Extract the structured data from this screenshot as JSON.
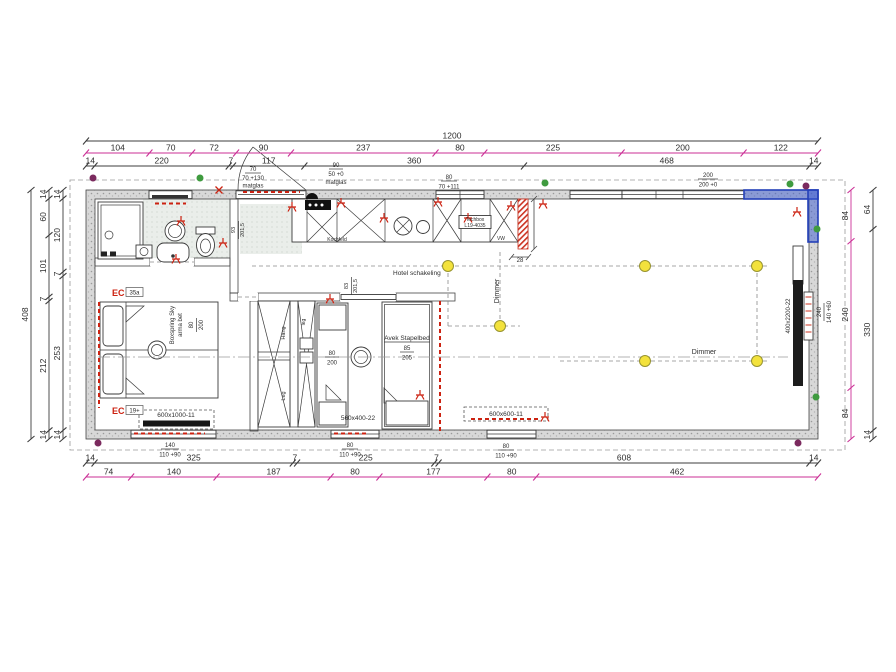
{
  "colors": {
    "magenta": "#cb2f96",
    "dimension_black": "#3c3c3c",
    "electric_red": "#cc2211",
    "new_wall_blue": "#2f4fc4",
    "light_yellow": "#f3e23c",
    "dot_green": "#3f9b3f",
    "dot_purple": "#7b2a5e",
    "wall_gray": "#d8d8d8"
  },
  "dimensions": {
    "top_total": "1200",
    "top_magenta": [
      "104",
      "70",
      "72",
      "90",
      "237",
      "80",
      "225",
      "200",
      "122"
    ],
    "top_black": [
      "14",
      "220",
      "7",
      "117",
      "360",
      "468",
      "14"
    ],
    "bottom_black": [
      "14",
      "325",
      "7",
      "225",
      "7",
      "608",
      "14"
    ],
    "bottom_magenta": [
      "74",
      "140",
      "187",
      "80",
      "177",
      "80",
      "462"
    ],
    "left_total": "408",
    "left_mid": [
      "14",
      "60",
      "101",
      "7",
      "212",
      "14"
    ],
    "left_inner": [
      "14",
      "120",
      "7",
      "253",
      "14"
    ],
    "right_magenta": [
      "84",
      "240",
      "84"
    ],
    "right_black": [
      "64",
      "330",
      "14"
    ]
  },
  "window_labels": {
    "bath_top": {
      "num": "70",
      "den": "70 +130",
      "note": "matglas"
    },
    "entry_side": {
      "num": "90",
      "den": "50 +0",
      "note": "matglas"
    },
    "kitchen_top": {
      "num": "80",
      "den": "70 +111"
    },
    "living_top": {
      "num": "200",
      "den": "200 +0"
    },
    "bedroom_bottom": {
      "num": "140",
      "den": "110 +90"
    },
    "kids_bottom": {
      "num": "80",
      "den": "110 +90"
    },
    "living_bottom": {
      "num": "80",
      "den": "110 +90"
    },
    "right_wall": {
      "num": "240",
      "den": "140 +60"
    }
  },
  "doors": {
    "entry": {
      "num": "93",
      "den": "201,5"
    },
    "kids": {
      "num": "83",
      "den": "201,5"
    }
  },
  "furniture": {
    "bed_brand": "Boxspring Sky",
    "bed_type": "arma bet",
    "bed_num": "80",
    "bed_den": "200",
    "single_num": "80",
    "single_den": "200",
    "bunk_name": "Avek Stapelbed",
    "bunk_num": "85",
    "bunk_den": "205",
    "hang": "Hang",
    "leg": "Leg",
    "leg_small": "leg",
    "hob": "Kochfeld",
    "techbox_line1": "Techbox",
    "techbox_line2": "L19-4035",
    "vw": "VW",
    "radiator_tag": "400x2200-22",
    "bedroom_unit": "600x1000-11",
    "kids_unit": "560x400-22",
    "living_unit": "600x600-11"
  },
  "electrical": {
    "hotel_switch": "Hotel schakeling",
    "dimmer_a": "Dimmer",
    "dimmer_b": "Dimmer",
    "ec_top": "EC",
    "ec_top_tag": "35a",
    "ec_bottom": "EC",
    "ec_bottom_tag": "19+",
    "dim_28": "28"
  }
}
